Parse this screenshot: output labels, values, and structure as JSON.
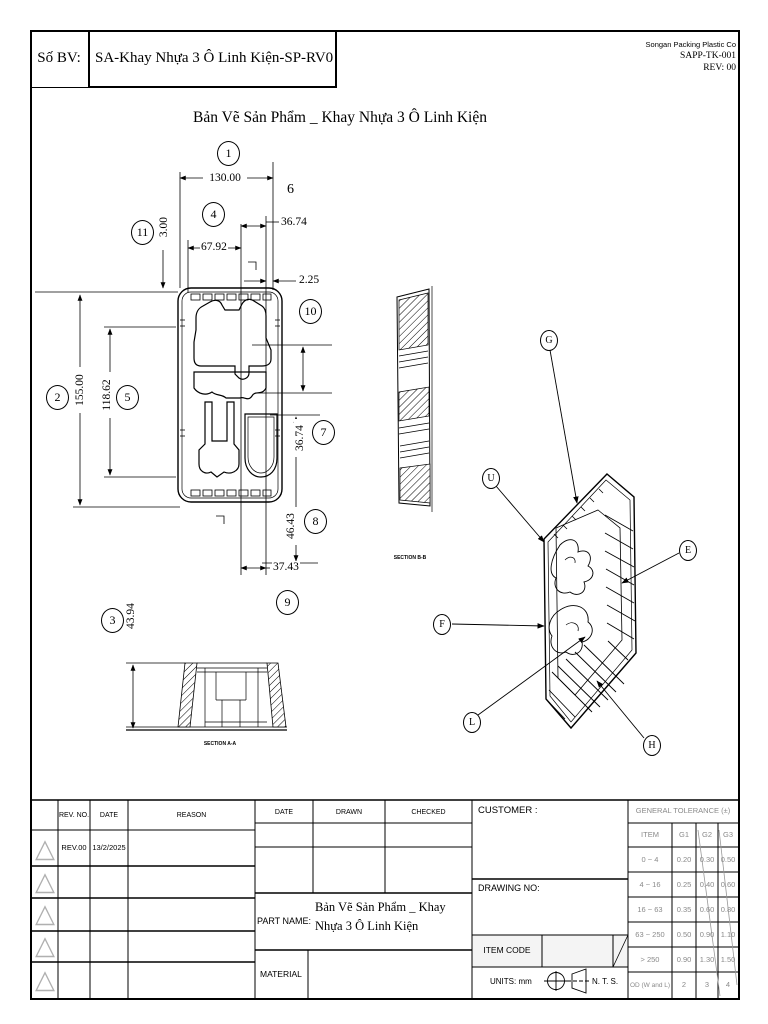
{
  "header": {
    "so_bv_label": "Số BV:",
    "drawing_code": "SA-Khay Nhựa 3 Ô Linh Kiện-SP-RV0",
    "company": "Songan Packing Plastic Co",
    "doc_code": "SAPP-TK-001",
    "revision": "REV: 00"
  },
  "title": "Bản Vẽ Sản Phẩm _ Khay Nhựa 3 Ô Linh Kiện",
  "dims": {
    "d130": "130.00",
    "d36_74_top": "36.74",
    "d67_92": "67.92",
    "d2_25": "2.25",
    "d3_00": "3.00",
    "d155": "155.00",
    "d118_62": "118.62",
    "d36_74_right": "36.74",
    "d46_43": "46.43",
    "d37_43": "37.43",
    "d43_94": "43.94",
    "n6": "6"
  },
  "balloons": {
    "b1": "1",
    "b2": "2",
    "b3": "3",
    "b4": "4",
    "b5": "5",
    "b7": "7",
    "b8": "8",
    "b9": "9",
    "b10": "10",
    "b11": "11"
  },
  "letters": {
    "g": "G",
    "u": "U",
    "e": "E",
    "f": "F",
    "l": "L",
    "h": "H"
  },
  "sections": {
    "a": "SECTION A-A",
    "b": "SECTION B-B"
  },
  "revision": {
    "triangle_icon": "△",
    "headers": {
      "rev_no": "REV. NO.",
      "date": "DATE",
      "reason": "REASON"
    },
    "rows": [
      {
        "rev": "REV.00",
        "date": "13/2/2025",
        "reason": ""
      },
      {
        "rev": "",
        "date": "",
        "reason": ""
      },
      {
        "rev": "",
        "date": "",
        "reason": ""
      },
      {
        "rev": "",
        "date": "",
        "reason": ""
      },
      {
        "rev": "",
        "date": "",
        "reason": ""
      }
    ]
  },
  "title_block": {
    "date_label": "DATE",
    "drawn_label": "DRAWN",
    "checked_label": "CHECKED",
    "part_name_label": "PART NAME:",
    "part_name": "Bản Vẽ Sản Phẩm _ Khay Nhựa 3 Ô Linh Kiện",
    "material_label": "MATERIAL",
    "customer_label": "CUSTOMER :",
    "drawing_no_label": "DRAWING NO:",
    "item_code_label": "ITEM CODE",
    "units_label": "UNITS: mm",
    "scale_label": "N. T. S."
  },
  "tolerance": {
    "title": "GENERAL TOLERANCE (±)",
    "headers": [
      "ITEM",
      "G1",
      "G2",
      "G3"
    ],
    "rows": [
      [
        "0 ~ 4",
        "0.20",
        "0.30",
        "0.50"
      ],
      [
        "4 ~ 16",
        "0.25",
        "0.40",
        "0.60"
      ],
      [
        "16 ~ 63",
        "0.35",
        "0.60",
        "0.80"
      ],
      [
        "63 ~ 250",
        "0.50",
        "0.90",
        "1.10"
      ],
      [
        "> 250",
        "0.90",
        "1.30",
        "1.50"
      ],
      [
        "OD (W and L)",
        "2",
        "3",
        "4"
      ]
    ]
  }
}
